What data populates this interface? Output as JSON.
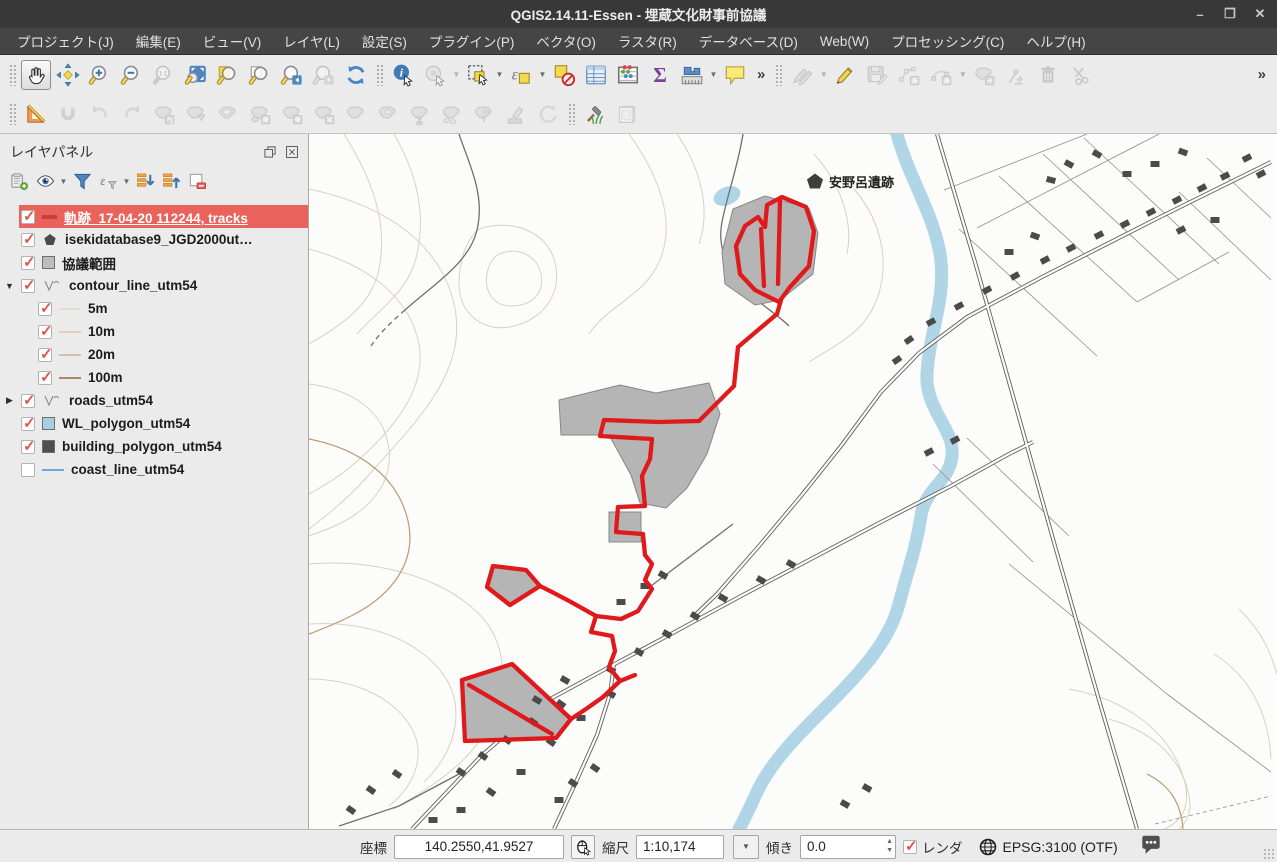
{
  "window": {
    "title": "QGIS2.14.11-Essen - 埋蔵文化財事前協議",
    "minimize": "–",
    "maximize": "❐",
    "close": "✕"
  },
  "menu_bar": {
    "items": [
      {
        "name": "menu-project",
        "label": "プロジェクト(J)"
      },
      {
        "name": "menu-edit",
        "label": "編集(E)"
      },
      {
        "name": "menu-view",
        "label": "ビュー(V)"
      },
      {
        "name": "menu-layer",
        "label": "レイヤ(L)"
      },
      {
        "name": "menu-settings",
        "label": "設定(S)"
      },
      {
        "name": "menu-plugins",
        "label": "プラグイン(P)"
      },
      {
        "name": "menu-vector",
        "label": "ベクタ(O)"
      },
      {
        "name": "menu-raster",
        "label": "ラスタ(R)"
      },
      {
        "name": "menu-database",
        "label": "データベース(D)"
      },
      {
        "name": "menu-web",
        "label": "Web(W)"
      },
      {
        "name": "menu-processing",
        "label": "プロセッシング(C)"
      },
      {
        "name": "menu-help",
        "label": "ヘルプ(H)"
      }
    ]
  },
  "toolbars": {
    "row1": [
      {
        "type": "grip"
      },
      {
        "name": "pan-map-button",
        "icon": "hand",
        "active": true
      },
      {
        "name": "pan-to-selection-button",
        "icon": "pan-sel"
      },
      {
        "name": "zoom-in-button",
        "icon": "zoom-in"
      },
      {
        "name": "zoom-out-button",
        "icon": "zoom-out"
      },
      {
        "name": "zoom-native-button",
        "icon": "zoom-native",
        "disabled": true
      },
      {
        "name": "zoom-full-button",
        "icon": "zoom-full"
      },
      {
        "name": "zoom-to-selection-button",
        "icon": "zoom-sel"
      },
      {
        "name": "zoom-to-layer-button",
        "icon": "zoom-layer"
      },
      {
        "name": "zoom-last-button",
        "icon": "zoom-last"
      },
      {
        "name": "zoom-next-button",
        "icon": "zoom-next",
        "disabled": true
      },
      {
        "name": "refresh-button",
        "icon": "refresh"
      },
      {
        "type": "grip"
      },
      {
        "name": "identify-button",
        "icon": "identify"
      },
      {
        "name": "feature-action-button",
        "icon": "action",
        "disabled": true,
        "dropdown": true
      },
      {
        "name": "select-features-button",
        "icon": "select",
        "dropdown": true
      },
      {
        "name": "select-by-expression-button",
        "icon": "select-expr",
        "dropdown": true
      },
      {
        "name": "deselect-all-button",
        "icon": "deselect"
      },
      {
        "name": "attribute-table-button",
        "icon": "attr-table"
      },
      {
        "name": "field-calculator-button",
        "icon": "abacus"
      },
      {
        "name": "statistics-button",
        "icon": "sigma"
      },
      {
        "name": "measure-button",
        "icon": "measure",
        "dropdown": true
      },
      {
        "name": "map-tips-button",
        "icon": "maptip"
      },
      {
        "type": "overflow",
        "name": "toolbar-overflow-mid"
      },
      {
        "type": "grip"
      },
      {
        "name": "current-edits-button",
        "icon": "pencils",
        "disabled": true,
        "dropdown": true
      },
      {
        "name": "toggle-editing-button",
        "icon": "pencil"
      },
      {
        "name": "save-edits-button",
        "icon": "save-edit",
        "disabled": true
      },
      {
        "name": "add-feature-button",
        "icon": "add-feature",
        "disabled": true
      },
      {
        "name": "circular-string-button",
        "icon": "circular",
        "disabled": true,
        "dropdown": true
      },
      {
        "name": "move-feature-button",
        "icon": "move-feature",
        "disabled": true
      },
      {
        "name": "node-tool-button",
        "icon": "node-tool",
        "disabled": true
      },
      {
        "name": "delete-selected-button",
        "icon": "trash",
        "disabled": true
      },
      {
        "name": "cut-features-button",
        "icon": "scissors",
        "disabled": true
      },
      {
        "type": "spacer"
      },
      {
        "type": "overflow",
        "name": "toolbar-overflow-right"
      }
    ],
    "row2": [
      {
        "type": "grip"
      },
      {
        "name": "cad-tools-button",
        "icon": "set-square"
      },
      {
        "name": "snapping-button",
        "icon": "magnet",
        "disabled": true
      },
      {
        "name": "undo-button",
        "icon": "undo",
        "disabled": true
      },
      {
        "name": "redo-button",
        "icon": "redo",
        "disabled": true
      },
      {
        "name": "rotate-feature-button",
        "icon": "blob-rotate",
        "disabled": true
      },
      {
        "name": "simplify-feature-button",
        "icon": "blob-down",
        "disabled": true
      },
      {
        "name": "add-ring-button",
        "icon": "blob-ring",
        "disabled": true
      },
      {
        "name": "add-part-button",
        "icon": "blob-part",
        "disabled": true
      },
      {
        "name": "fill-ring-button",
        "icon": "blob-fill",
        "disabled": true
      },
      {
        "name": "delete-ring-button",
        "icon": "blob-x",
        "disabled": true
      },
      {
        "name": "delete-part-button",
        "icon": "blob-plain",
        "disabled": true
      },
      {
        "name": "reshape-button",
        "icon": "blob-ring2",
        "disabled": true
      },
      {
        "name": "split-features-button",
        "icon": "split",
        "disabled": true
      },
      {
        "name": "split-parts-button",
        "icon": "split-parts",
        "disabled": true
      },
      {
        "name": "merge-features-button",
        "icon": "merge",
        "disabled": true
      },
      {
        "name": "offset-curve-button",
        "icon": "pen-drip",
        "disabled": true
      },
      {
        "name": "rotate-point-button",
        "icon": "rotate",
        "disabled": true
      },
      {
        "type": "grip"
      },
      {
        "name": "osm-tools-button",
        "icon": "hammer-grass"
      },
      {
        "name": "composer-button",
        "icon": "scroll",
        "disabled": true
      }
    ]
  },
  "layer_panel": {
    "title": "レイヤパネル",
    "toolbar": [
      {
        "name": "add-group-button",
        "icon": "add-group"
      },
      {
        "name": "manage-visibility-button",
        "icon": "eye",
        "dropdown": true
      },
      {
        "name": "filter-legend-button",
        "icon": "funnel"
      },
      {
        "name": "filter-expression-button",
        "icon": "eps-filter",
        "dropdown": true
      },
      {
        "name": "expand-all-button",
        "icon": "expand-all"
      },
      {
        "name": "collapse-all-button",
        "icon": "collapse-all"
      },
      {
        "name": "remove-layer-button",
        "icon": "remove-layer"
      }
    ],
    "layers": [
      {
        "name": "layer-tracks",
        "label": "軌跡_17-04-20 112244, tracks",
        "checked": true,
        "selected": true,
        "symbol": {
          "type": "trackline",
          "color": "#c8403a"
        }
      },
      {
        "name": "layer-isekidatabase",
        "label": "isekidatabase9_JGD2000ut…",
        "checked": true,
        "symbol": {
          "type": "pentagon",
          "color": "#4a4a4a"
        }
      },
      {
        "name": "layer-kyougi-hani",
        "label": "協議範囲",
        "checked": true,
        "symbol": {
          "type": "polygon",
          "color": "#bdbdbd"
        }
      },
      {
        "name": "layer-contour-line",
        "label": "contour_line_utm54",
        "checked": true,
        "expanded": true,
        "symbol": {
          "type": "vline",
          "color": "#8a8a8a"
        },
        "children": [
          {
            "name": "layer-contour-5m",
            "label": "5m",
            "checked": true,
            "symbol": {
              "type": "line",
              "color": "#e7dccd"
            }
          },
          {
            "name": "layer-contour-10m",
            "label": "10m",
            "checked": true,
            "symbol": {
              "type": "line",
              "color": "#ded0bd"
            }
          },
          {
            "name": "layer-contour-20m",
            "label": "20m",
            "checked": true,
            "symbol": {
              "type": "line",
              "color": "#d2c1a7"
            }
          },
          {
            "name": "layer-contour-100m",
            "label": "100m",
            "checked": true,
            "symbol": {
              "type": "line",
              "color": "#a9896a"
            }
          }
        ]
      },
      {
        "name": "layer-roads",
        "label": "roads_utm54",
        "checked": true,
        "collapsed": true,
        "symbol": {
          "type": "vline",
          "color": "#8a8a8a"
        }
      },
      {
        "name": "layer-wl-polygon",
        "label": "WL_polygon_utm54",
        "checked": true,
        "symbol": {
          "type": "polygon",
          "color": "#a9cee3"
        }
      },
      {
        "name": "layer-building-polygon",
        "label": "building_polygon_utm54",
        "checked": true,
        "symbol": {
          "type": "polygon",
          "color": "#4f4f4f"
        }
      },
      {
        "name": "layer-coast-line",
        "label": "coast_line_utm54",
        "checked": false,
        "symbol": {
          "type": "line",
          "color": "#6fa8dc"
        }
      }
    ]
  },
  "map": {
    "annotation": "安野呂遺跡"
  },
  "status_bar": {
    "coord_label": "座標",
    "coord_value": "140.2550,41.9527",
    "scale_label": "縮尺",
    "scale_value": "1:10,174",
    "rotation_label": "傾き",
    "rotation_value": "0.0",
    "render_label": "レンダ",
    "render_checked": true,
    "crs_label": "EPSG:3100 (OTF)"
  },
  "colors": {
    "selection_highlight": "#e9635c",
    "track_red": "#e0191c",
    "river_blue": "#b0d5e6",
    "consult_polygon_gray": "#b5b5b5",
    "contour_tan": "#dcd0bf"
  }
}
